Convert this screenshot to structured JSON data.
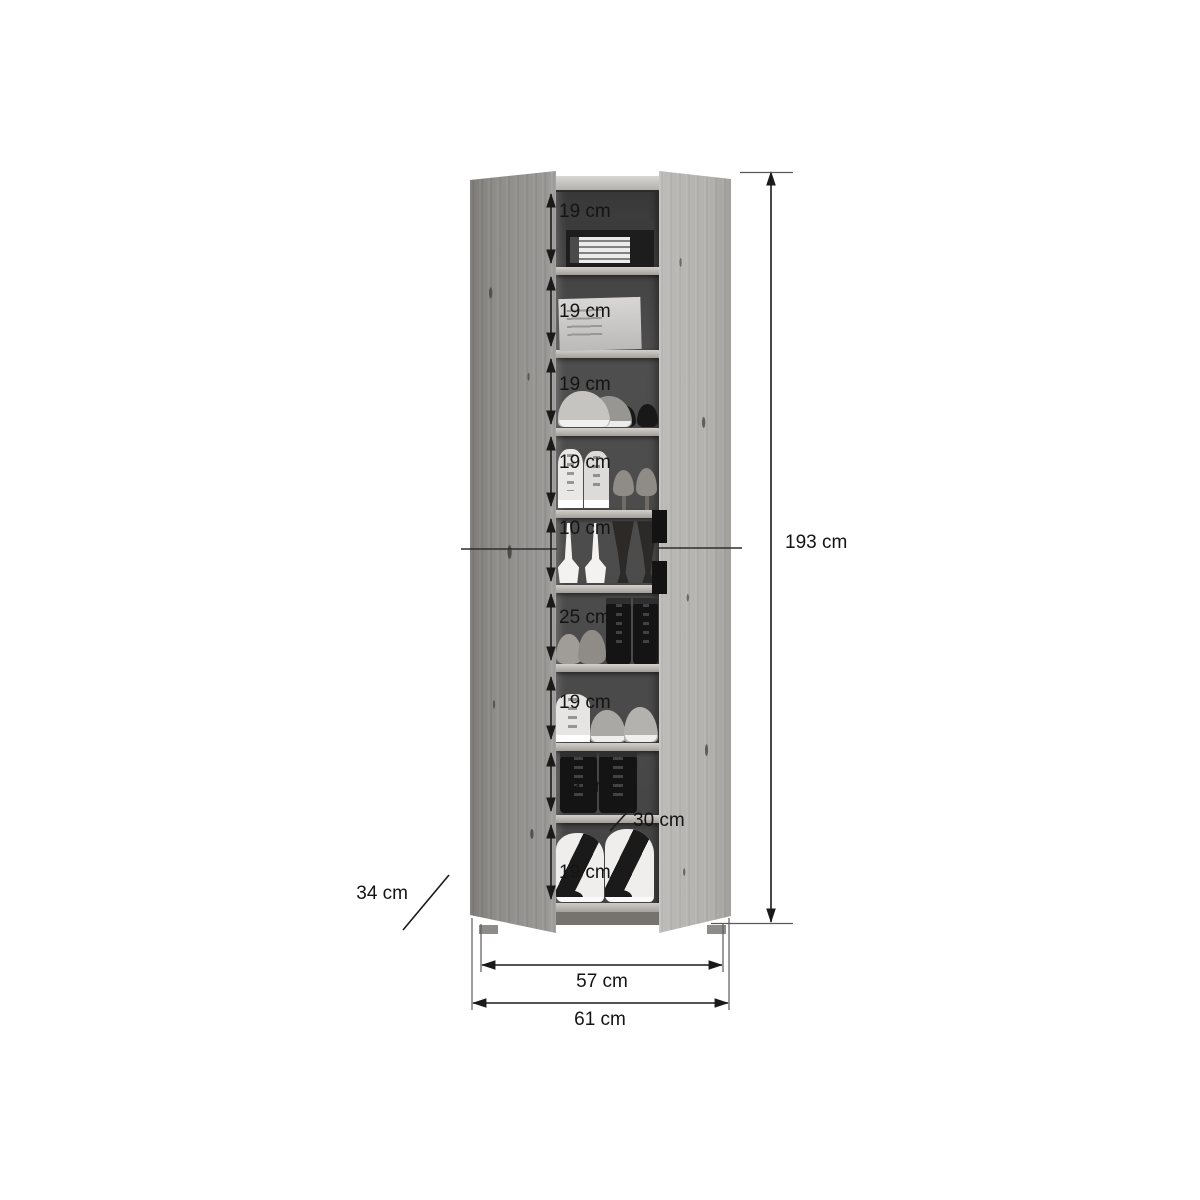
{
  "diagram": {
    "type": "furniture-dimension-diagram",
    "product": "shoe-cabinet-with-open-doors",
    "dimensions": {
      "overall_height": "193 cm",
      "inner_width": "57 cm",
      "overall_width": "61 cm",
      "depth": "34 cm",
      "shelf_depth": "30 cm"
    },
    "compartments": [
      {
        "label": "19 cm",
        "contents": "black-shoe-box"
      },
      {
        "label": "19 cm",
        "contents": "white-shoe-box"
      },
      {
        "label": "19 cm",
        "contents": "gray-sneakers-and-black-flats"
      },
      {
        "label": "19 cm",
        "contents": "white-high-top-sneakers-and-pumps"
      },
      {
        "label": "10 cm",
        "contents": "white-heeled-sandals-and-dark-pumps"
      },
      {
        "label": "25 cm",
        "contents": "flats-and-black-lace-up-boots"
      },
      {
        "label": "19 cm",
        "contents": "white-and-gray-sneakers"
      },
      {
        "label": "19 cm",
        "contents": "black-ankle-boots"
      },
      {
        "label": "19 cm",
        "contents": "black-white-wedge-high-top-sneakers"
      }
    ],
    "colors": {
      "background": "#ffffff",
      "wood_left_door": "#8f8d8a",
      "wood_right_door": "#b4b2af",
      "interior_back": "#4a4a4a",
      "shelf": "#b5b2ae",
      "handle": "#131313",
      "dimension_line": "#1a1a1a"
    }
  }
}
